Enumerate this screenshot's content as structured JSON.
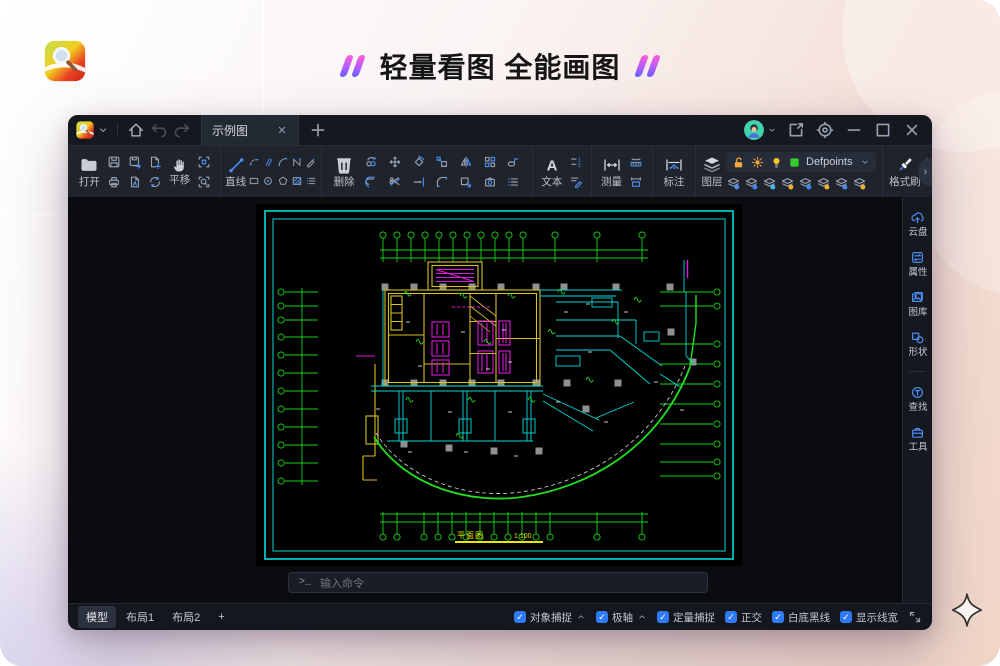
{
  "header": {
    "tagline": "轻量看图 全能画图"
  },
  "titlebar": {
    "tab_title": "示例图",
    "icons": [
      "app-logo",
      "chevron-down",
      "home",
      "undo",
      "redo",
      "tab-close",
      "new-tab",
      "avatar",
      "chevron-down",
      "share",
      "settings",
      "minimize",
      "maximize",
      "close"
    ]
  },
  "toolbar": {
    "open_label": "打开",
    "pan_label": "平移",
    "line_label": "直线",
    "delete_label": "删除",
    "text_label": "文本",
    "measure_label": "测量",
    "annotate_label": "标注",
    "layer_label": "图层",
    "layer_current": "Defpoints",
    "format_brush_label": "格式刷",
    "color_label": "颜色",
    "linetype_label": "线型",
    "expander_glyph": "›",
    "icon_names": {
      "file_group": [
        "folder",
        "save",
        "print",
        "save-as",
        "pdf",
        "new-file",
        "refresh",
        "hand",
        "fit-screen",
        "zoom-search"
      ],
      "draw_group": [
        "line",
        "polyline",
        "rectangle",
        "parallel",
        "circle",
        "arc",
        "polygon",
        "spline",
        "hatch",
        "pen",
        "list"
      ],
      "modify_group": [
        "trash",
        "copy",
        "offset",
        "move",
        "trim",
        "rotate",
        "extend",
        "scale",
        "fillet",
        "mirror",
        "block",
        "array",
        "camera-block",
        "stretch",
        "list"
      ],
      "text_group": [
        "text-A",
        "numbering",
        "text-edit"
      ],
      "measure_group": [
        "measure",
        "dim-ruler",
        "dim-rect"
      ],
      "annotate_group": [
        "annotate"
      ],
      "layer_group": [
        "layers",
        "unlock",
        "sun",
        "bulb",
        "green-swatch",
        "layer-states×8"
      ],
      "format_group": [
        "format-brush",
        "color-swatch",
        "linetype-sample"
      ]
    }
  },
  "sidebar": {
    "items": [
      {
        "label": "云盘",
        "icon": "cloud-upload"
      },
      {
        "label": "属性",
        "icon": "properties"
      },
      {
        "label": "图库",
        "icon": "gallery"
      },
      {
        "label": "形状",
        "icon": "shapes"
      },
      {
        "label": "查找",
        "icon": "find"
      },
      {
        "label": "工具",
        "icon": "toolbox"
      }
    ]
  },
  "command": {
    "prompt": ">_",
    "placeholder": "输入命令"
  },
  "statusbar": {
    "model_tab": "模型",
    "layout1_tab": "布局1",
    "layout2_tab": "布局2",
    "add_layout": "+",
    "check_glyph": "✓",
    "toggles": [
      {
        "label": "对象捕捉",
        "checked": true,
        "has_menu": true
      },
      {
        "label": "极轴",
        "checked": true,
        "has_menu": true
      },
      {
        "label": "定量捕捉",
        "checked": true
      },
      {
        "label": "正交",
        "checked": true
      },
      {
        "label": "白底黑线",
        "checked": true
      },
      {
        "label": "显示线宽",
        "checked": true
      }
    ]
  },
  "drawing": {
    "plan_title": "平面图",
    "scale": "1:100",
    "colors": {
      "frame_cyan": "#00d9d9",
      "axis_green": "#17d517",
      "wall_yellow": "#d8c020",
      "equipment_magenta": "#e018e0",
      "boundary_green": "#1fe01f",
      "column_gray": "#909090"
    }
  },
  "ui_colors": {
    "accent_blue": "#4a8df0",
    "checkbox_blue": "#2f7bf5",
    "layer_swatch_green": "#35cb2f",
    "lock_orange": "#f2a93b",
    "bulb_yellow": "#f6c81f"
  }
}
